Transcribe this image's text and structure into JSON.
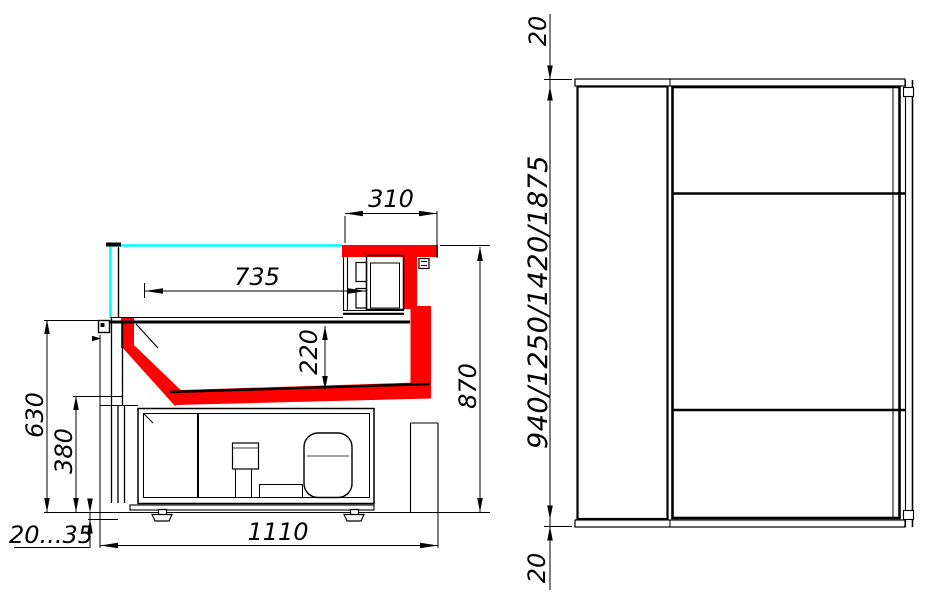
{
  "colors": {
    "highlight": "#ff0000",
    "glass": "#00ffff",
    "line": "#000000"
  },
  "section_view": {
    "dims": {
      "canopy_depth": "310",
      "display_opening_depth": "735",
      "well_height": "220",
      "worktop_height": "630",
      "base_height": "380",
      "overall_height": "870",
      "overall_depth": "1110",
      "leg_adjust_range": "20...35"
    }
  },
  "plan_view": {
    "dims": {
      "top_overhang": "20",
      "length_options": "940/1250/1420/1875",
      "bottom_overhang": "20"
    }
  }
}
